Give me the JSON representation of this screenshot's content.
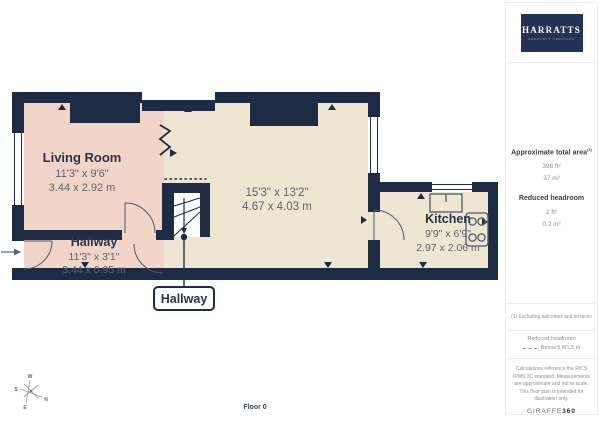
{
  "page": {
    "floor_label": "Floor 0"
  },
  "brand": {
    "name": "HARRATTS",
    "tagline": "PROPERTY SERVICES"
  },
  "sidebar": {
    "area_title": "Approximate total area",
    "area_footnote_ref": "(1)",
    "area_ft": "398 ft²",
    "area_m": "37 m²",
    "headroom_title": "Reduced headroom",
    "headroom_ft": "2 ft²",
    "headroom_m": "0.2 m²",
    "footnote": "(1) Excluding balconies and terraces",
    "legend_title": "Reduced headroom",
    "legend_label": "Below 5 ft/1.5 m",
    "disclaimer": "Calculations reference the RICS IPMS 3C standard. Measurements are approximate and not to scale. This floor plan is intended for illustration only.",
    "watermark_name": "GIRAFFE",
    "watermark_suffix": "360"
  },
  "floorplan": {
    "living_room": {
      "name": "Living Room",
      "imperial": "11'3\" x 9'6\"",
      "metric": "3.44 x 2.92 m"
    },
    "reception": {
      "imperial": "15'3\" x 13'2\"",
      "metric": "4.67 x 4.03 m"
    },
    "kitchen": {
      "name": "Kitchen",
      "imperial": "9'9\" x 6'9\"",
      "metric": "2.97 x 2.06 m"
    },
    "hallway": {
      "name": "Hallway",
      "imperial": "11'3\" x 3'1\"",
      "metric": "3.44 x 0.95 m"
    },
    "callout": "Hallway",
    "compass": {
      "n": "N",
      "e": "E",
      "s": "S",
      "w": "W"
    }
  },
  "colors": {
    "wall": "#1d2b44",
    "room_pink": "#f3d4c8",
    "room_beige": "#efe6d2",
    "logo_navy": "#233358",
    "logo_gold": "#b19b6e",
    "text_dark": "#2b3345",
    "text_dim": "#5d6470",
    "line_light": "#ededed"
  }
}
